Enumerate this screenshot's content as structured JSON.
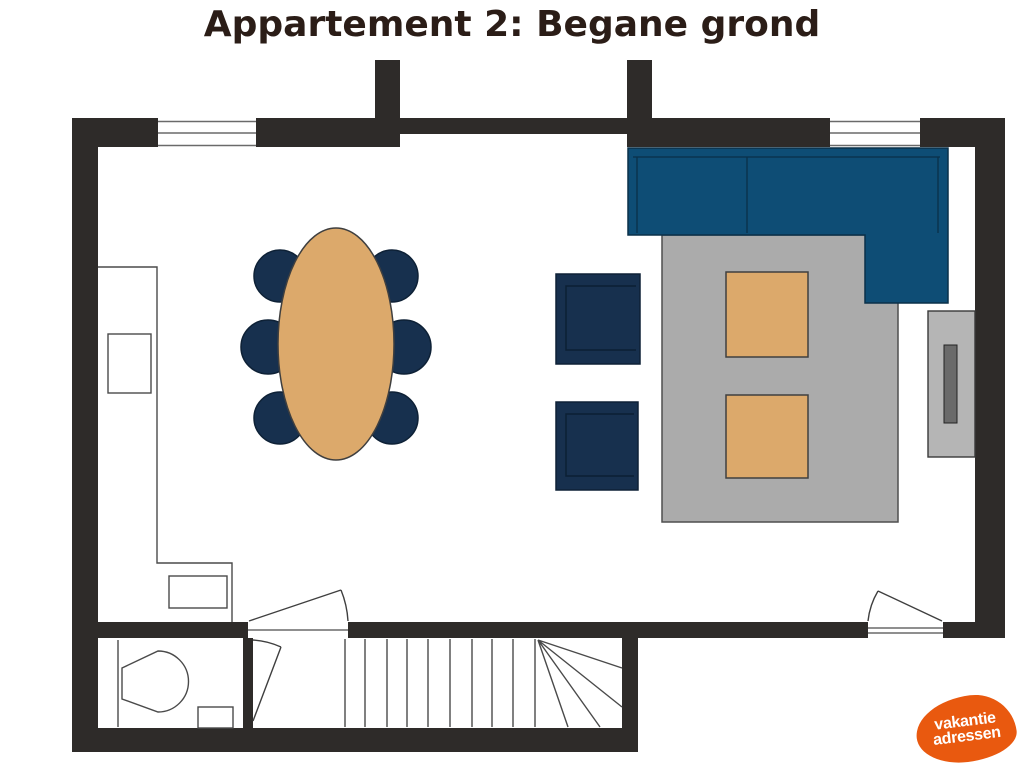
{
  "title": "Appartement 2: Begane grond",
  "logo": {
    "line1": "vakantie",
    "line2": "adressen"
  },
  "colors": {
    "wall": "#2e2b29",
    "ink": "#2b1d17",
    "navy": "#17304e",
    "blue": "#0e4d75",
    "tan": "#dca96b",
    "rug": "#ababab",
    "cabinet": "#b5b5b5",
    "tv": "#6a6a6a",
    "orange": "#e9590f",
    "line": "#4a4a4a"
  },
  "floorplan": {
    "floor": "Begane grond",
    "apartment": "Appartement 2",
    "furniture": [
      "l-shaped-sofa",
      "area-rug",
      "coffee-table",
      "coffee-table",
      "armchair",
      "armchair",
      "tv-cabinet",
      "tv",
      "oval-dining-table",
      "dining-chair-x6",
      "kitchen-counter",
      "kitchen-sink",
      "toilet",
      "hand-basin",
      "staircase"
    ],
    "windows": 2,
    "doors": 3
  }
}
